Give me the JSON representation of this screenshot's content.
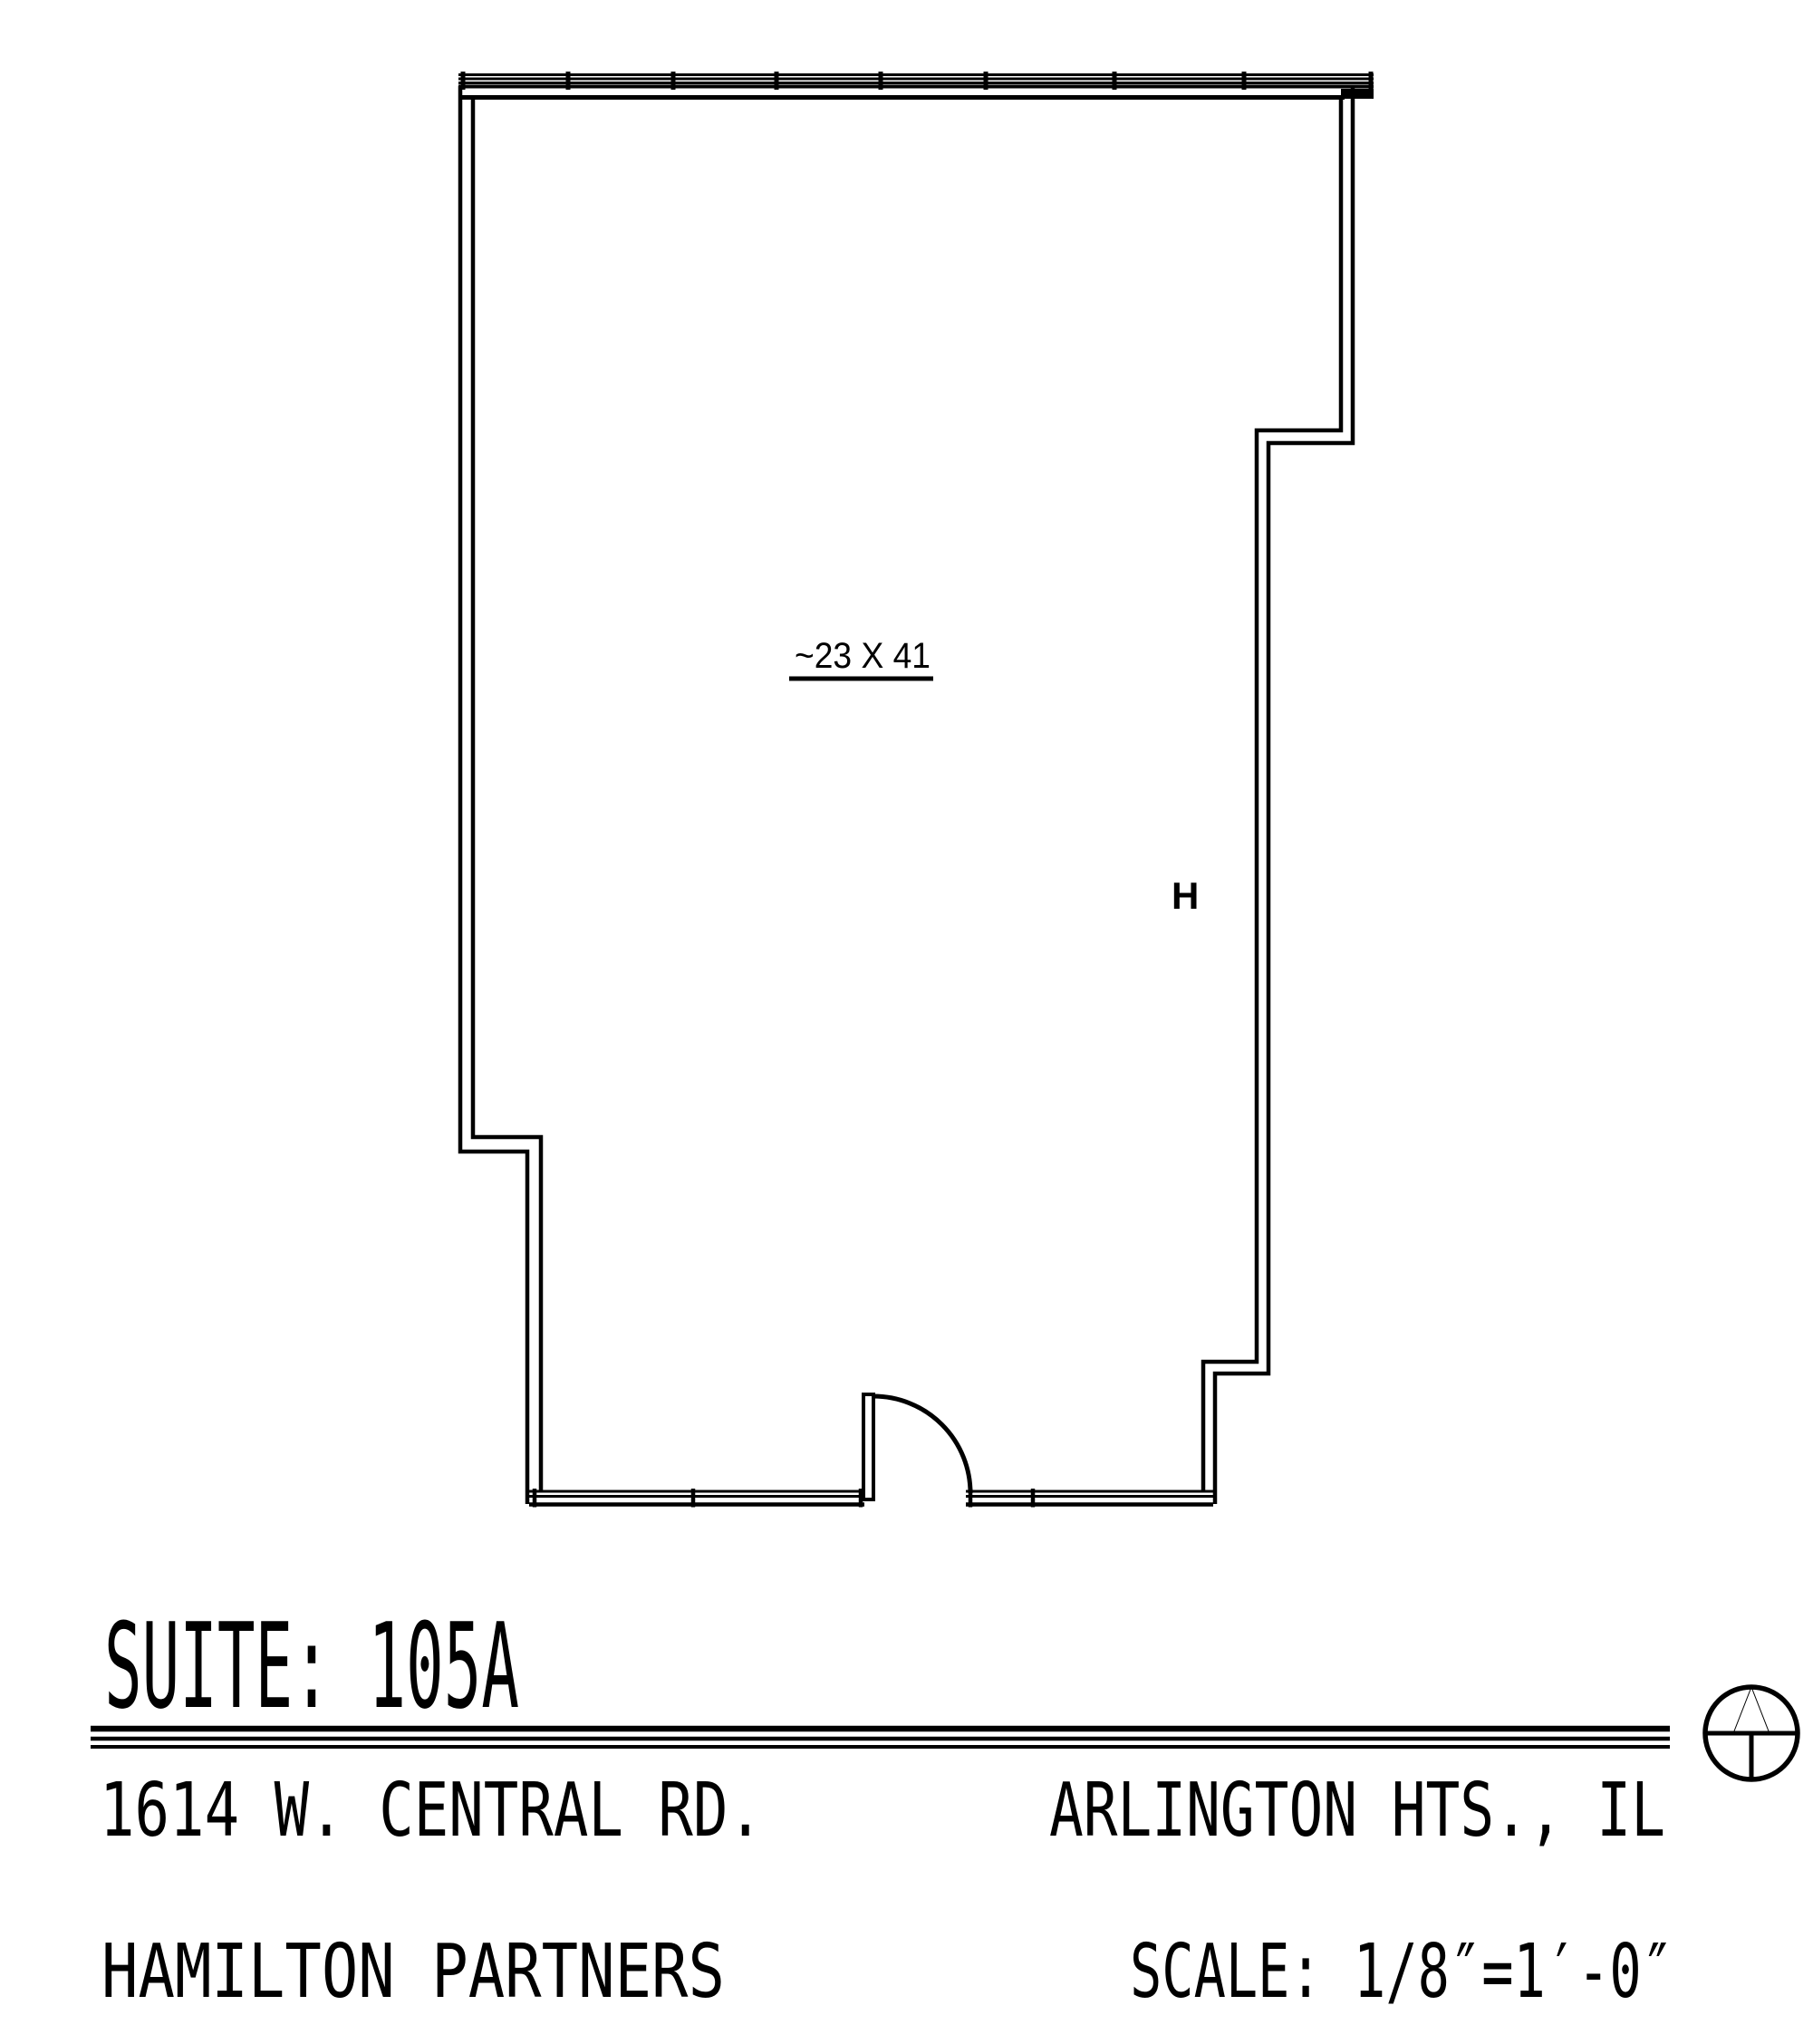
{
  "floor_plan": {
    "area_label": "~23 X 41",
    "door_hardware_marker": "H"
  },
  "title_block": {
    "suite_title": "SUITE: 105A",
    "street_address": "1614 W. CENTRAL RD.",
    "city_state": "ARLINGTON HTS., IL",
    "company": "HAMILTON PARTNERS",
    "scale_label": "SCALE: 1/8″=1′-0″"
  },
  "icons": {
    "north_arrow": "compass circle with cross and filled north triangle"
  },
  "colors": {
    "line": "#000000",
    "background": "#ffffff"
  }
}
